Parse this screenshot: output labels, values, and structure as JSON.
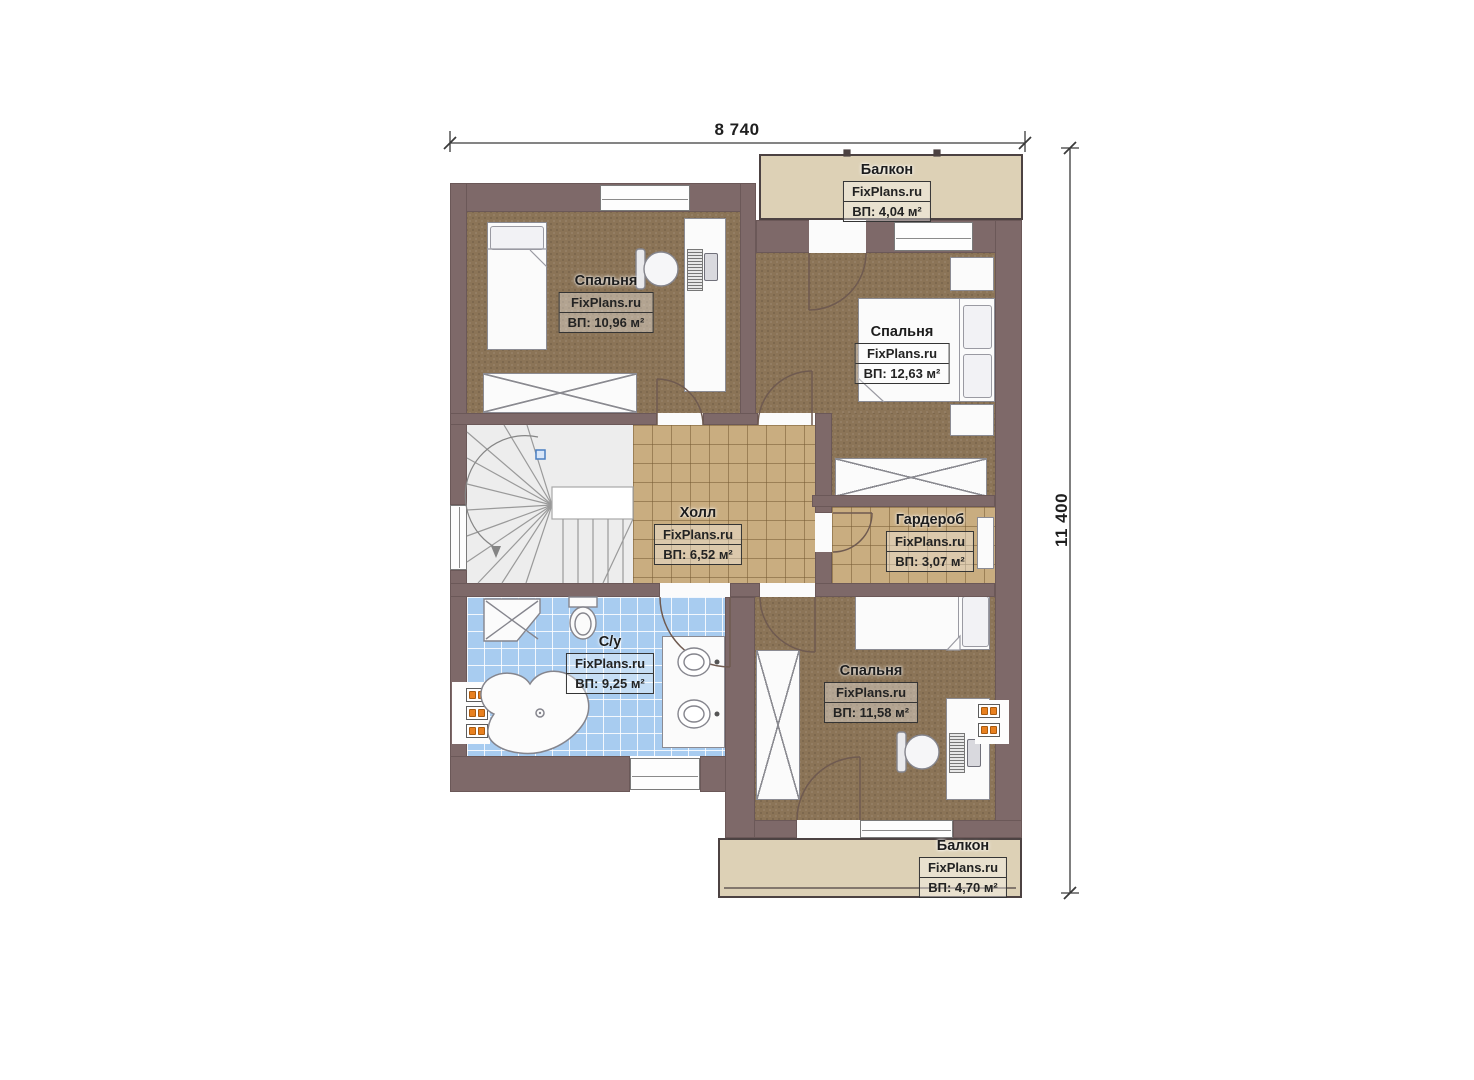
{
  "plan": {
    "dimensions": {
      "width_label": "8 740",
      "height_label": "11 400"
    },
    "rooms": {
      "balcony_top": {
        "name": "Балкон",
        "brand": "FixPlans.ru",
        "area": "ВП: 4,04 м²"
      },
      "bedroom_top_left": {
        "name": "Спальня",
        "brand": "FixPlans.ru",
        "area": "ВП: 10,96 м²"
      },
      "bedroom_top_right": {
        "name": "Спальня",
        "brand": "FixPlans.ru",
        "area": "ВП: 12,63 м²"
      },
      "hall": {
        "name": "Холл",
        "brand": "FixPlans.ru",
        "area": "ВП: 6,52 м²"
      },
      "wardrobe": {
        "name": "Гардероб",
        "brand": "FixPlans.ru",
        "area": "ВП: 3,07 м²"
      },
      "bathroom": {
        "name": "С/у",
        "brand": "FixPlans.ru",
        "area": "ВП: 9,25 м²"
      },
      "bedroom_bottom": {
        "name": "Спальня",
        "brand": "FixPlans.ru",
        "area": "ВП: 11,58 м²"
      },
      "balcony_bottom": {
        "name": "Балкон",
        "brand": "FixPlans.ru",
        "area": "ВП: 4,70 м²"
      }
    },
    "colors": {
      "wall": "#7e6969",
      "carpet": "#8b7457",
      "tile": "#c9ad80",
      "bathroom_tile": "#a8ccf0",
      "balcony_floor": "#ddd1b6",
      "radiator": "#e8801f",
      "marker_blue": "#4a7fc1"
    }
  }
}
